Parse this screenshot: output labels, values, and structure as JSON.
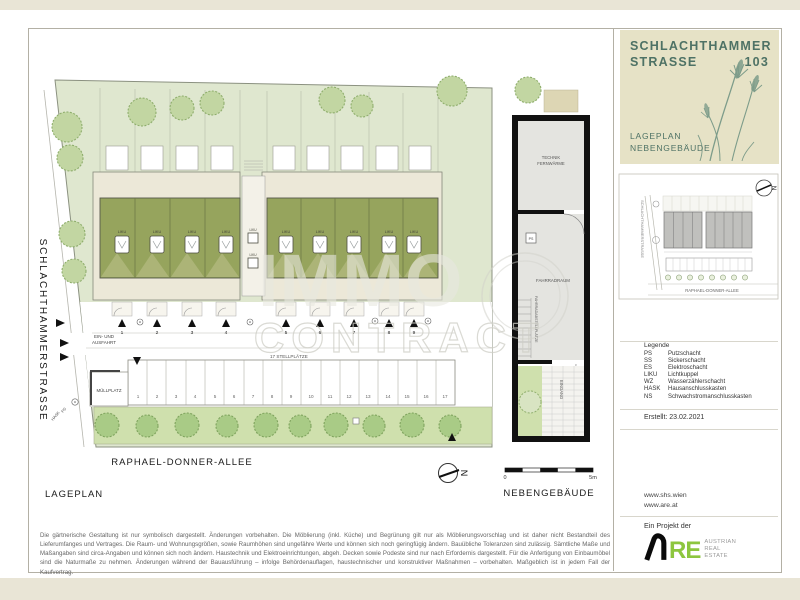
{
  "colors": {
    "title_green": "#4e7265",
    "panel_beige": "#e6e2c6",
    "roof_green": "#96a45d",
    "lawn_green": "#dfe7cf",
    "strip_green": "#cfe0ad",
    "logo_green": "#8dc63f",
    "wall_black": "#111111"
  },
  "title_block": {
    "title_line1": "SCHLACHTHAMMER",
    "title_line2": "STRASSE",
    "title_number": "103",
    "subtitle_line1": "LAGEPLAN",
    "subtitle_line2": "NEBENGEBÄUDE"
  },
  "minimap": {
    "street_left": "SCHLACHTHAMMERSTRASSE",
    "street_bottom": "RAPHAEL-DONNER-ALLEE",
    "north": "N"
  },
  "legend": {
    "heading": "Legende",
    "entries": [
      {
        "abbr": "PS",
        "term": "Putzschacht"
      },
      {
        "abbr": "SS",
        "term": "Sickerschacht"
      },
      {
        "abbr": "ES",
        "term": "Elektroschacht"
      },
      {
        "abbr": "LIKU",
        "term": "Lichtkuppel"
      },
      {
        "abbr": "WZ",
        "term": "Wasserzählerschacht"
      },
      {
        "abbr": "HASK",
        "term": "Hausanschlusskasten"
      },
      {
        "abbr": "NS",
        "term": "Schwachstromanschlusskasten"
      }
    ],
    "created": "Erstellt: 23.02.2021"
  },
  "links": {
    "website1": "www.shs.wien",
    "website2": "www.are.at"
  },
  "project": {
    "label": "Ein Projekt der",
    "logo_text": "RE",
    "caption_line1": "AUSTRIAN",
    "caption_line2": "REAL",
    "caption_line3": "ESTATE"
  },
  "plan": {
    "street_left": "SCHLACHTHAMMERSTRASSE",
    "street_bottom": "RAPHAEL-DONNER-ALLEE",
    "caption": "LAGEPLAN",
    "liku": "LIKU",
    "entry_line1": "EIN- UND",
    "entry_line2": "AUSFAHRT",
    "muellplatz": "MÜLLPLATZ",
    "stellplaetze": "17 STELLPLÄTZE",
    "ps": "PS",
    "hask": "HASK",
    "north": "N",
    "house_numbers": [
      "1",
      "2",
      "3",
      "4",
      "5",
      "6",
      "7",
      "8",
      "9"
    ],
    "parking_numbers": [
      "1",
      "2",
      "3",
      "4",
      "5",
      "6",
      "7",
      "8",
      "9",
      "10",
      "11",
      "12",
      "13",
      "14",
      "15",
      "16",
      "17"
    ]
  },
  "outbuilding": {
    "caption": "NEBENGEBÄUDE",
    "room_top_line1": "TECHNIK",
    "room_top_line2": "FERNWÄRME",
    "room_mid": "FAHRRADRAUM",
    "room_mid_side": "FAHRRADABSTELLPLÄTZE",
    "entrance": "EINGANG",
    "ps": "PS",
    "scale_zero": "0",
    "scale_five": "5m"
  },
  "watermark": {
    "line1": "IMMO",
    "line2": "CONTRACT"
  },
  "footer": {
    "disclaimer": "Die gärtnerische Gestaltung ist nur symbolisch dargestellt. Änderungen vorbehalten. Die Möblierung (inkl. Küche) und Begrünung gilt nur als Möblierungsvorschlag und ist daher nicht Bestandteil des Lieferumfanges und Vertrages. Die Raum- und Wohnungsgrößen, sowie Raumhöhen sind ungefähre Werte und können sich noch geringfügig ändern. Bauübliche Toleranzen sind zulässig. Sämtliche Maße und Maßangaben sind circa-Angaben und können sich noch ändern. Haustechnik und Elektroeinrichtungen, abgeh. Decken sowie Podeste sind nur nach Erfordernis dargestellt. Für die Anfertigung von Einbaumöbel sind die Naturmaße zu nehmen. Änderungen während der Bauausführung – infolge Behördenauflagen, haustechnischer und konstruktiver Maßnahmen – vorbehalten. Maßgeblich ist in jedem Fall der Kaufvertrag."
  }
}
